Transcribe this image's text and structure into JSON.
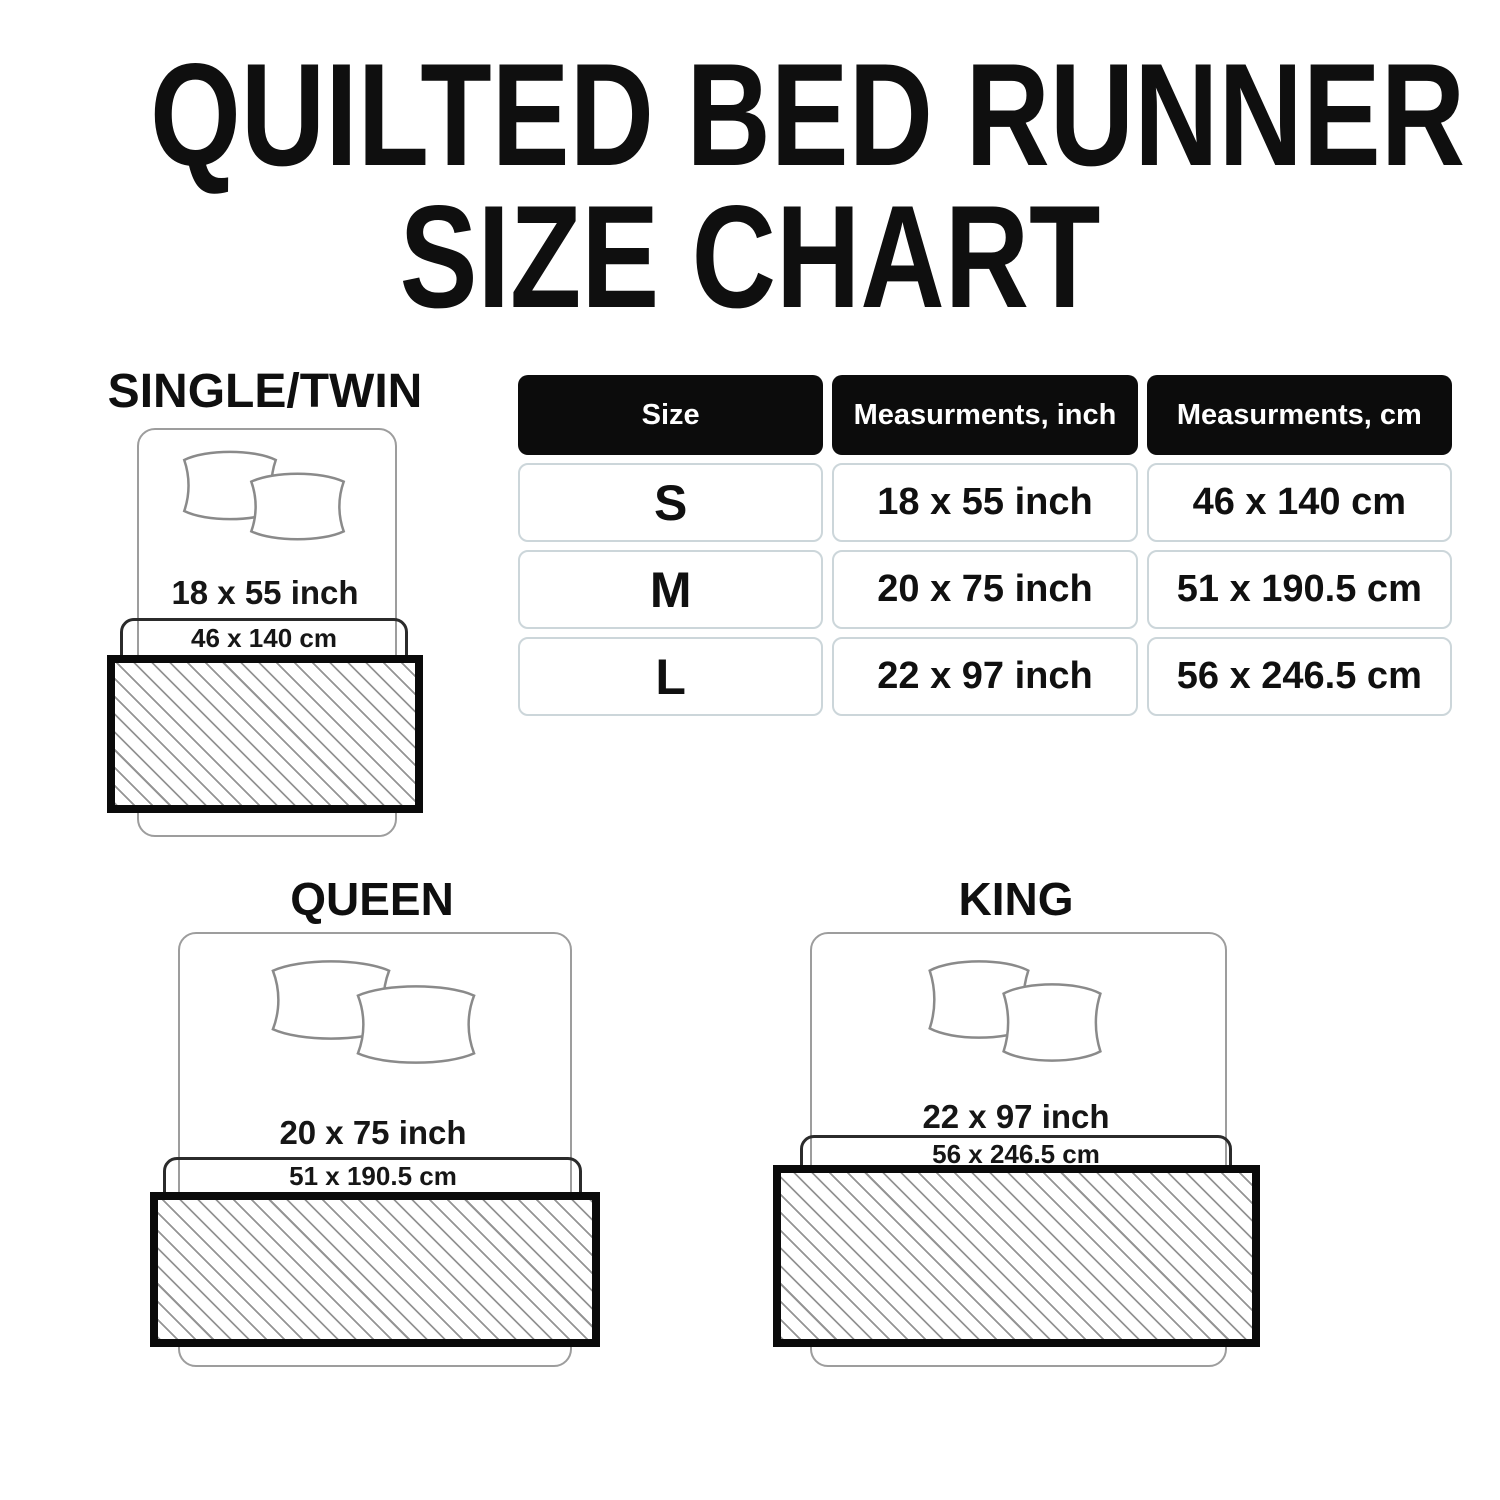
{
  "title": {
    "line1": "QUILTED BED RUNNER",
    "line2": "SIZE CHART"
  },
  "table": {
    "headers": [
      "Size",
      "Measurments, inch",
      "Measurments, cm"
    ],
    "rows": [
      {
        "size": "S",
        "inch": "18 x 55 inch",
        "cm": "46 x 140 cm"
      },
      {
        "size": "M",
        "inch": "20 x 75 inch",
        "cm": "51 x 190.5 cm"
      },
      {
        "size": "L",
        "inch": "22 x 97 inch",
        "cm": "56 x 246.5 cm"
      }
    ]
  },
  "diagrams": [
    {
      "name": "SINGLE/TWIN",
      "inch": "18 x 55 inch",
      "cm": "46 x 140 cm"
    },
    {
      "name": "QUEEN",
      "inch": "20 x 75 inch",
      "cm": "51 x 190.5 cm"
    },
    {
      "name": "KING",
      "inch": "22 x 97 inch",
      "cm": "56 x 246.5 cm"
    }
  ],
  "colors": {
    "background": "#ffffff",
    "text": "#111111",
    "table_header_bg": "#0c0c0c",
    "table_header_text": "#ffffff",
    "table_cell_border": "#ccd6da",
    "bed_outline": "#9d9d9d",
    "runner_extent_outline": "#2b2b2b",
    "runner_border": "#0a0a0a",
    "hatch_line": "#949494"
  },
  "chart_data": {
    "type": "table",
    "title": "QUILTED BED RUNNER SIZE CHART",
    "columns": [
      "Size",
      "Measurments, inch",
      "Measurments, cm"
    ],
    "rows": [
      [
        "S",
        "18 x 55 inch",
        "46 x 140 cm"
      ],
      [
        "M",
        "20 x 75 inch",
        "51 x 190.5 cm"
      ],
      [
        "L",
        "22 x 97 inch",
        "56 x 246.5 cm"
      ]
    ]
  }
}
